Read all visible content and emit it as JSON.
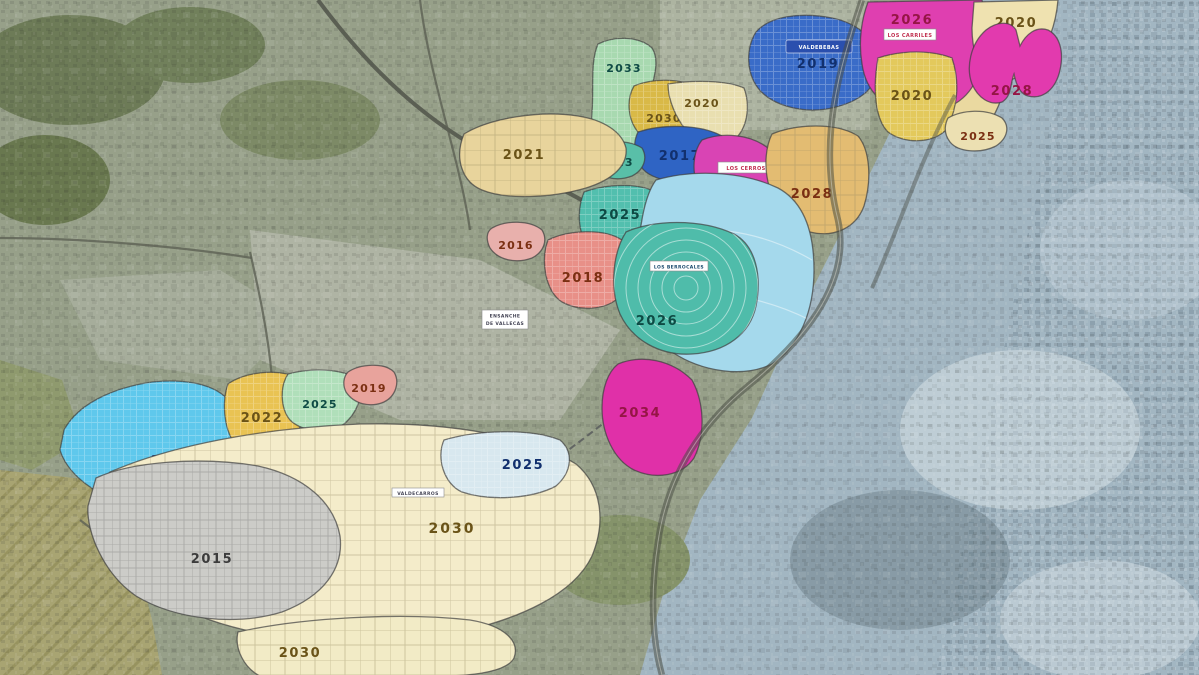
{
  "map": {
    "zones": [
      {
        "year": "2019",
        "name": "VALDEBEBAS",
        "color": "#3a6cc8"
      },
      {
        "year": "2026",
        "name": "LOS CARRILES",
        "color": "#df3fb0"
      },
      {
        "year": "2029",
        "color": "#ead9a0"
      },
      {
        "year": "2020",
        "color": "#e3c95c"
      },
      {
        "year": "2020",
        "color": "#efe2b0"
      },
      {
        "year": "2028",
        "color": "#e23aae"
      },
      {
        "year": "2025",
        "color": "#ece0b2"
      },
      {
        "year": "2033",
        "color": "#a8d9b0"
      },
      {
        "year": "2030",
        "color": "#d9b947"
      },
      {
        "year": "2020",
        "color": "#e9dfb0"
      },
      {
        "year": "2017",
        "color": "#2f64c4"
      },
      {
        "year": "2023",
        "color": "#59bfa8"
      },
      {
        "year": "2021",
        "color": "#e8d49c"
      },
      {
        "year": "2025",
        "name": "LOS CERROS",
        "color": "#d944b4"
      },
      {
        "year": "2028",
        "color": "#e3bc72"
      },
      {
        "year": "2025",
        "color": "#52bfae"
      },
      {
        "year": "2016",
        "color": "#e8b0ac"
      },
      {
        "year": "2018",
        "color": "#e89088"
      },
      {
        "year": "2024",
        "color": "#a5d9ec"
      },
      {
        "year": "2026",
        "name": "LOS BERROCALES",
        "color": "#4fbcaa"
      },
      {
        "year": "2012",
        "color": "#5fc8ec"
      },
      {
        "year": "2022",
        "color": "#e9c353"
      },
      {
        "year": "2025",
        "color": "#b0dfba"
      },
      {
        "year": "2019",
        "color": "#e8a39c"
      },
      {
        "year": "2034",
        "color": "#e030a8"
      },
      {
        "year": "2025",
        "color": "#d8e8ef"
      },
      {
        "year": "2030",
        "name": "VALDECARROS",
        "color": "#f4ecca"
      },
      {
        "year": "2015",
        "color": "#ccccc8"
      },
      {
        "year": "2030",
        "color": "#f2ebc6"
      }
    ],
    "annotations": {
      "district_line1": "ENSANCHE",
      "district_line2": "DE VALLECAS"
    },
    "background": {
      "terrain": "#97a089",
      "satellite_right": "#a2b6c2",
      "fields": "#a8a472",
      "forest": "#6d7b57",
      "urban": "#b5b9ab",
      "road": "#4c5048"
    }
  }
}
